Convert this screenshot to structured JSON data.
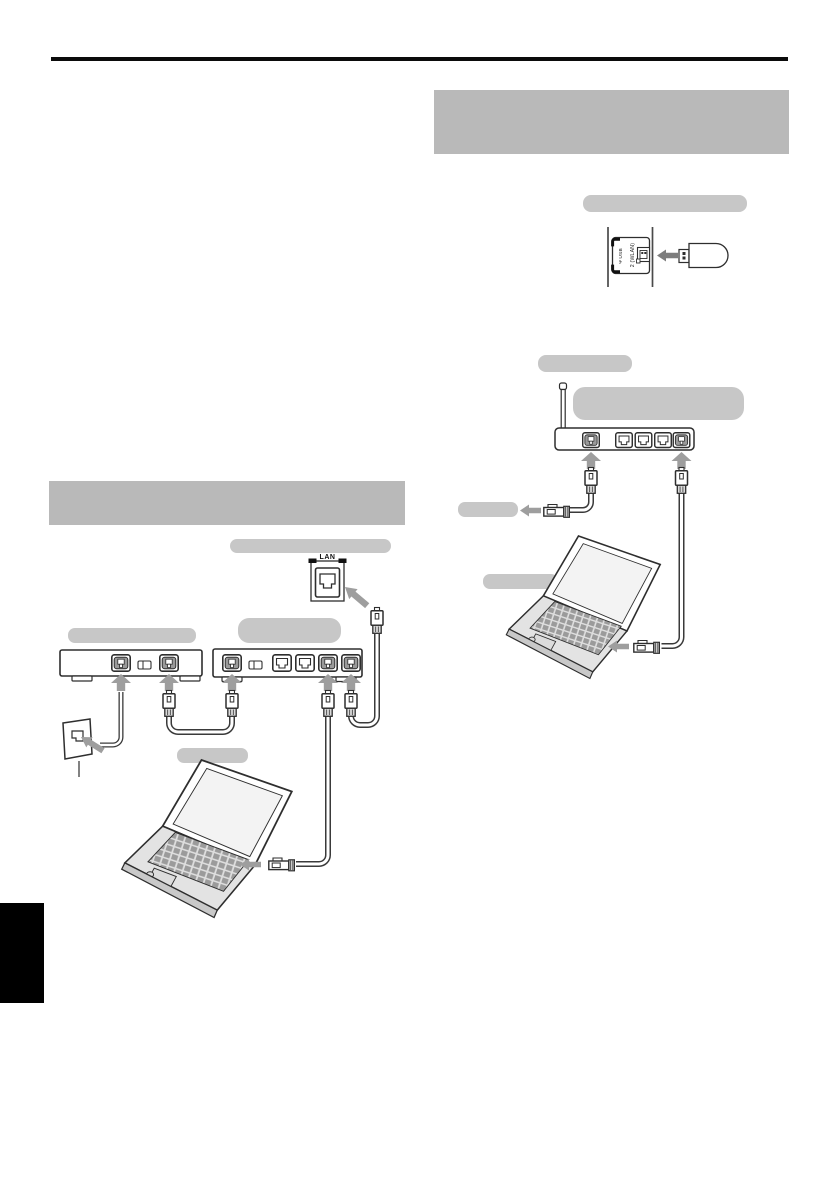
{
  "page": {
    "type": "scanned-manual-page-with-connection-diagrams",
    "background": "#ffffff",
    "has_top_rule": true
  },
  "colors": {
    "redacted_heading_block": "#b9b9b9",
    "redacted_label_pill": "#c7c7c7",
    "diagram_arrow": "#9e9e9e",
    "dongle_arrow": "#7d7d7d",
    "line_art": "#2e2e2e",
    "chapter_edge_tab": "#000000"
  },
  "left_diagram": {
    "lan_jack_label": "LAN",
    "modem_port_count": 2,
    "hub_port_count": 5,
    "depicted": [
      "wall-outlet",
      "modem",
      "hub-router",
      "lan-wall-jack",
      "laptop",
      "ethernet-cables"
    ]
  },
  "right_diagram": {
    "tv_side_panel": {
      "usb_symbol_glyph": "Ψ",
      "usb_label": "USB",
      "usb_port_label": "2 (WLAN)"
    },
    "wireless_router_port_count": 5,
    "depicted": [
      "tv-side-panel",
      "wireless-lan-adapter",
      "wireless-router",
      "laptop",
      "ethernet-cables"
    ]
  }
}
